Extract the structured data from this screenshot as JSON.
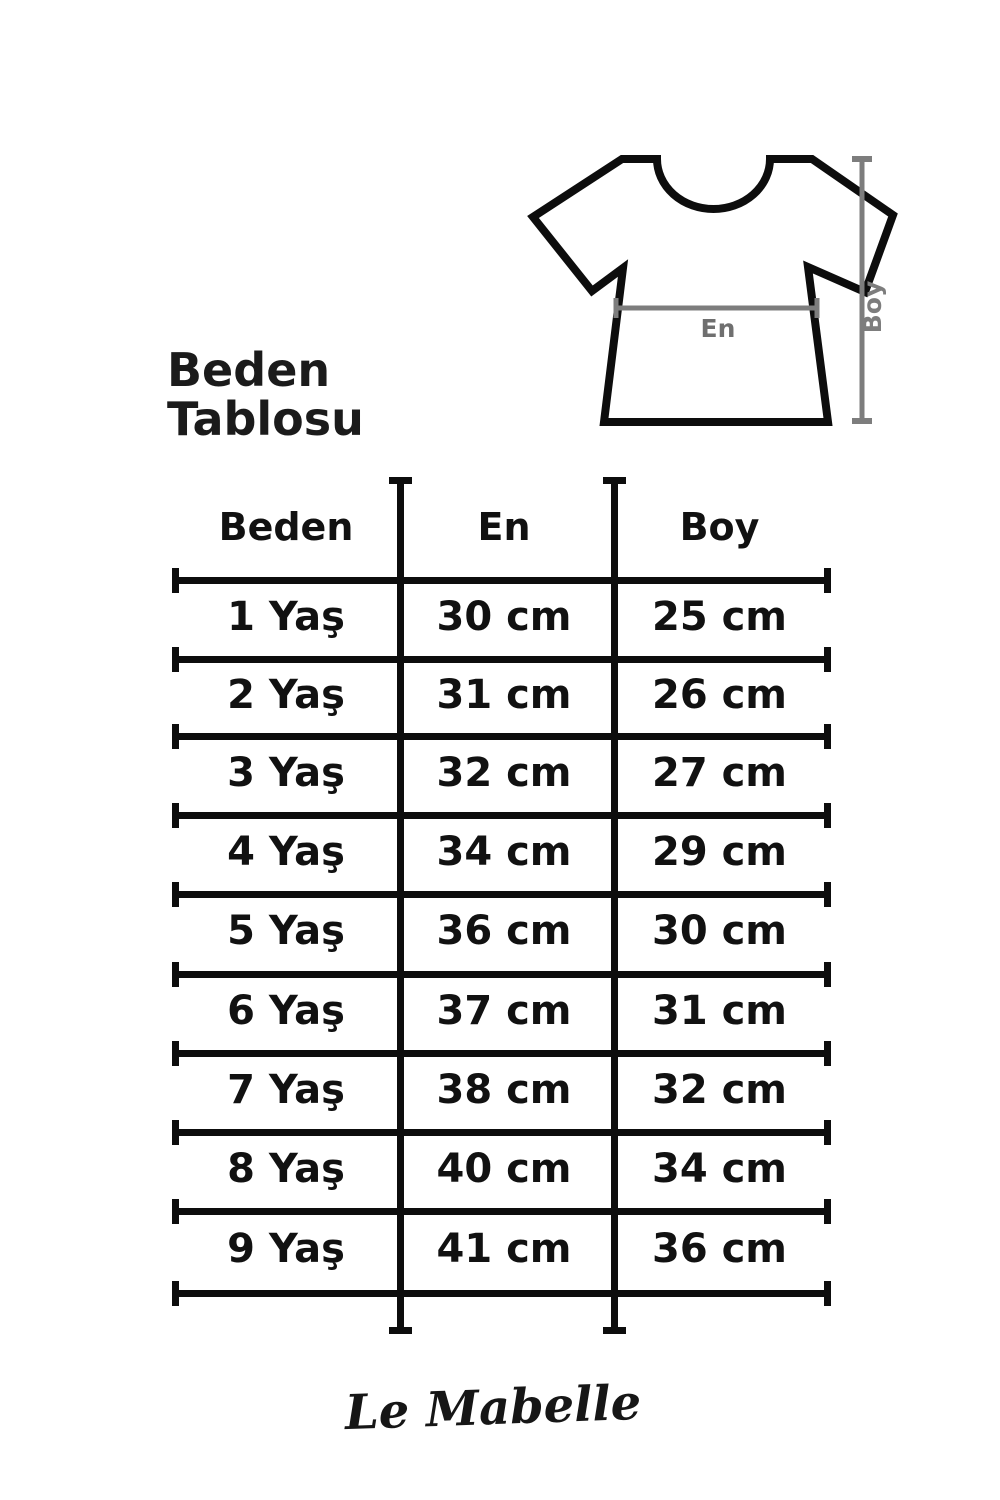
{
  "title": {
    "line1": "Beden",
    "line2": "Tablosu"
  },
  "diagram": {
    "width_label": "En",
    "height_label": "Boy"
  },
  "table": {
    "headers": {
      "size": "Beden",
      "width": "En",
      "height": "Boy"
    },
    "rows": [
      {
        "size": "1 Yaş",
        "en": "30 cm",
        "boy": "25 cm"
      },
      {
        "size": "2 Yaş",
        "en": "31 cm",
        "boy": "26 cm"
      },
      {
        "size": "3 Yaş",
        "en": "32 cm",
        "boy": "27 cm"
      },
      {
        "size": "4 Yaş",
        "en": "34 cm",
        "boy": "29 cm"
      },
      {
        "size": "5 Yaş",
        "en": "36 cm",
        "boy": "30 cm"
      },
      {
        "size": "6 Yaş",
        "en": "37 cm",
        "boy": "31 cm"
      },
      {
        "size": "7 Yaş",
        "en": "38 cm",
        "boy": "32 cm"
      },
      {
        "size": "8 Yaş",
        "en": "40 cm",
        "boy": "34 cm"
      },
      {
        "size": "9 Yaş",
        "en": "41 cm",
        "boy": "36 cm"
      }
    ]
  },
  "footer": {
    "brand": "Le Mabelle"
  },
  "colors": {
    "ink": "#111111",
    "table_line": "#0d0d0d",
    "measure_line": "#7d7d7d",
    "measure_label": "#6f6f6f",
    "background": "#ffffff"
  },
  "chart_data": {
    "type": "table",
    "title": "Beden Tablosu",
    "columns": [
      "Beden",
      "En",
      "Boy"
    ],
    "rows": [
      [
        "1 Yaş",
        "30 cm",
        "25 cm"
      ],
      [
        "2 Yaş",
        "31 cm",
        "26 cm"
      ],
      [
        "3 Yaş",
        "32 cm",
        "27 cm"
      ],
      [
        "4 Yaş",
        "34 cm",
        "29 cm"
      ],
      [
        "5 Yaş",
        "36 cm",
        "30 cm"
      ],
      [
        "6 Yaş",
        "37 cm",
        "31 cm"
      ],
      [
        "7 Yaş",
        "38 cm",
        "32 cm"
      ],
      [
        "8 Yaş",
        "40 cm",
        "34 cm"
      ],
      [
        "9 Yaş",
        "41 cm",
        "36 cm"
      ]
    ],
    "units": "cm",
    "notes": "En = garment width measured across chest; Boy = garment length measured top to hem"
  }
}
